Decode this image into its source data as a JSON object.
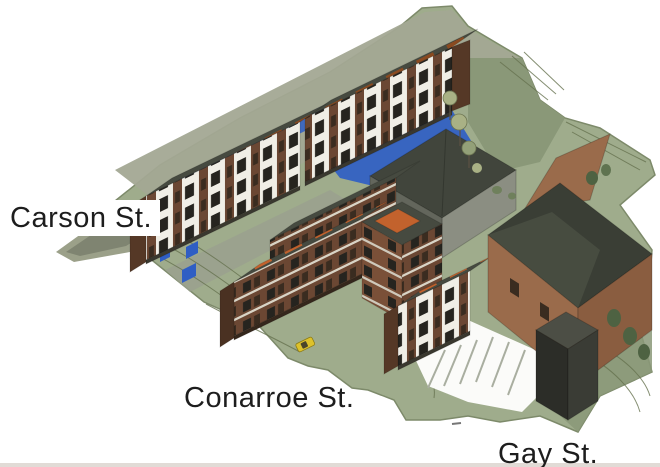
{
  "scene": {
    "type": "aerial-site-rendering",
    "labels": {
      "street_1": "Carson St.",
      "street_2": "Conarroe St.",
      "street_3": "Gay St."
    },
    "colors": {
      "background": "#ffffff",
      "label_ink": "#1d1d1d",
      "terrain_green": "#9fac8c",
      "terrain_shadow": "#8a9878",
      "street_band": "#a3a894",
      "road_gray": "#9aa08e",
      "contour_line": "#66724f",
      "roof_orange": "#c2622d",
      "roof_dark": "#464a40",
      "facade_white": "#f0eee6",
      "window_dark": "#26241f",
      "wall_brown": "#6b4733",
      "wall_brown_dark": "#553826",
      "big_building_brown": "#9a6b4b",
      "big_building_brown_shade": "#8a5d40",
      "big_building_gray": "#8b8e82",
      "big_building_gray_shade": "#63665c",
      "big_roof": "#3a3e35",
      "water_blue": "#2f5ec4",
      "annex_dark": "#2c2d28",
      "tree_dark": "#4e6242",
      "tree_light": "#a9b185",
      "parking_stripe": "#a9aea0",
      "car_yellow": "#ddc22c"
    }
  }
}
